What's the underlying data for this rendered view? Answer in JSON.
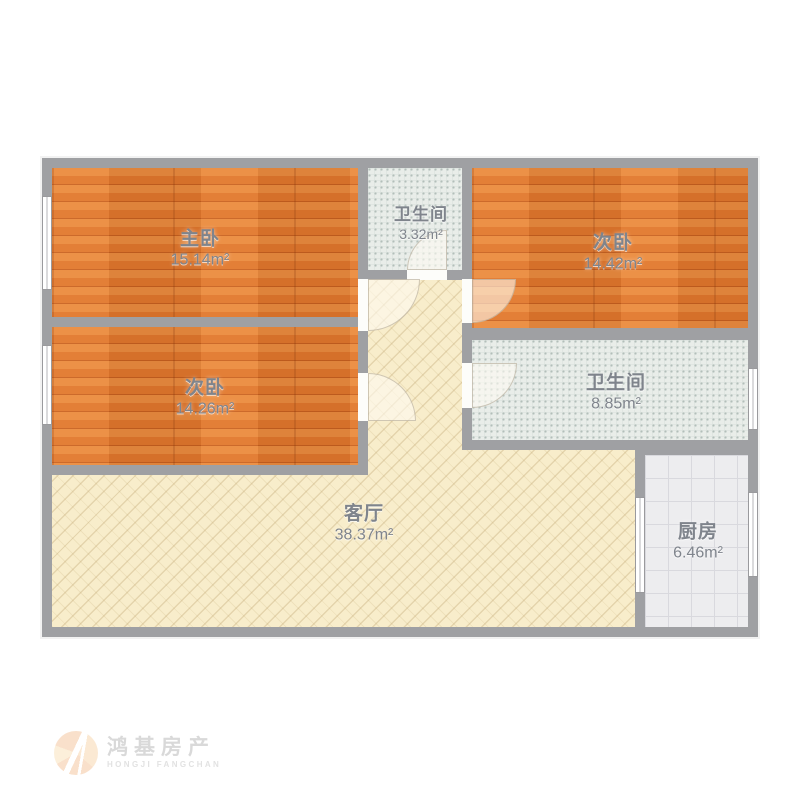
{
  "floorplan": {
    "title": "三室两卫户型图",
    "rooms": [
      {
        "key": "master-bedroom",
        "name": "主卧",
        "area": "15.14m²",
        "floor": "wood"
      },
      {
        "key": "bedroom-left",
        "name": "次卧",
        "area": "14.26m²",
        "floor": "wood"
      },
      {
        "key": "bedroom-right",
        "name": "次卧",
        "area": "14.42m²",
        "floor": "wood"
      },
      {
        "key": "bathroom-small",
        "name": "卫生间",
        "area": "3.32m²",
        "floor": "tile"
      },
      {
        "key": "bathroom-large",
        "name": "卫生间",
        "area": "8.85m²",
        "floor": "tile"
      },
      {
        "key": "living-room",
        "name": "客厅",
        "area": "38.37m²",
        "floor": "stripe"
      },
      {
        "key": "kitchen",
        "name": "厨房",
        "area": "6.46m²",
        "floor": "grid"
      }
    ]
  },
  "watermark": {
    "brand": "鸿基房产",
    "brand_en": "HONGJI FANGCHAN"
  },
  "colors": {
    "wall": "#9fa0a3",
    "wood_floor": "#e27c30",
    "living_floor": "#f8edcb",
    "tile_floor": "#e9ede9",
    "kitchen_floor": "#ededef",
    "label_text": "#7f848c"
  }
}
